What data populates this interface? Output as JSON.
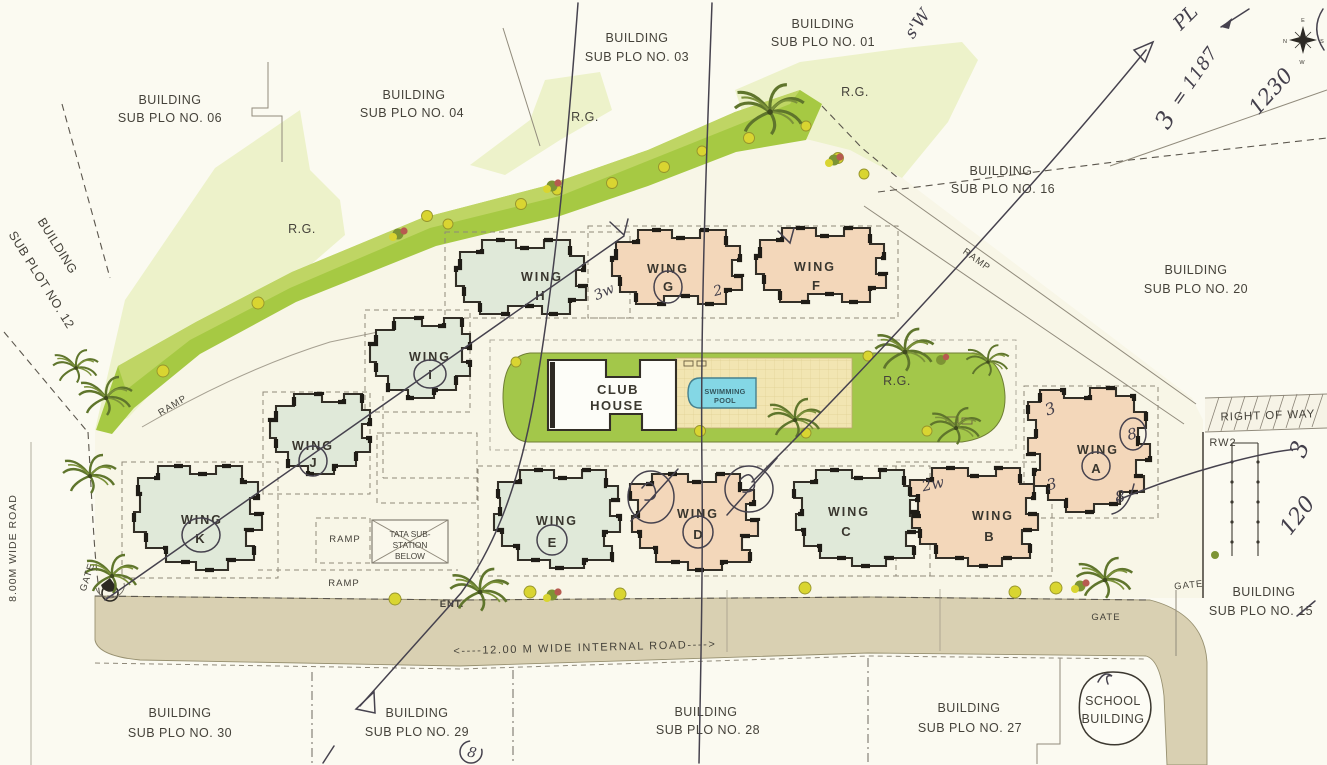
{
  "plots": [
    {
      "l1": "BUILDING",
      "l2": "SUB PLO NO. 06"
    },
    {
      "l1": "BUILDING",
      "l2": "SUB PLO NO. 04"
    },
    {
      "l1": "BUILDING",
      "l2": "SUB PLO NO. 03"
    },
    {
      "l1": "BUILDING",
      "l2": "SUB PLO NO. 01"
    },
    {
      "l1": "BUILDING",
      "l2": "SUB PLO NO. 16"
    },
    {
      "l1": "BUILDING",
      "l2": "SUB PLO NO. 20"
    },
    {
      "l1": "BUILDING",
      "l2": "SUB PLOT NO. 12"
    },
    {
      "l1": "BUILDING",
      "l2": "SUB PLO NO. 15"
    },
    {
      "l1": "BUILDING",
      "l2": "SUB PLO NO. 30"
    },
    {
      "l1": "BUILDING",
      "l2": "SUB PLO NO. 29"
    },
    {
      "l1": "BUILDING",
      "l2": "SUB PLO NO. 28"
    },
    {
      "l1": "BUILDING",
      "l2": "SUB PLO NO. 27"
    }
  ],
  "wing_word": "WING",
  "wings": [
    "H",
    "G",
    "F",
    "I",
    "J",
    "K",
    "E",
    "D",
    "C",
    "B",
    "A"
  ],
  "amenities": {
    "club1": "CLUB",
    "club2": "HOUSE",
    "pool1": "SWIMMING",
    "pool2": "POOL",
    "rg": "R.G.",
    "tata1": "TATA SUB-",
    "tata2": "STATION",
    "tata3": "BELOW",
    "school1": "SCHOOL",
    "school2": "BUILDING"
  },
  "roads": {
    "left_road": "8.00M WIDE ROAD",
    "internal_road": "<----12.00 M WIDE INTERNAL ROAD---->",
    "right_of_way": "RIGHT OF WAY",
    "rw2": "RW2",
    "ramp": "RAMP",
    "gate": "GATE",
    "ent": "ENT."
  },
  "handwritten": {
    "sw": "s'W",
    "pl": "PL",
    "eq1187": "= 1187",
    "three_top": "3",
    "n1230": "1230",
    "three_right": "3",
    "n120": "120",
    "g_left": "3w",
    "g_right": "2",
    "b_left": "2w",
    "a_tl": "3",
    "a_tr": "8",
    "a_bl": "3",
    "a_br": "8",
    "x29": "8"
  },
  "compass": {
    "n": "N",
    "e": "E",
    "s": "S",
    "w": "W"
  },
  "colors": {
    "pen": "#46424e",
    "lawn": "#a3c74a",
    "strip": "#a6c943",
    "pale": "#edf2ca",
    "road": "#d9d0b2",
    "mint": "#e0e9d9",
    "peach": "#f3d7ba",
    "pool": "#84d7e5"
  }
}
